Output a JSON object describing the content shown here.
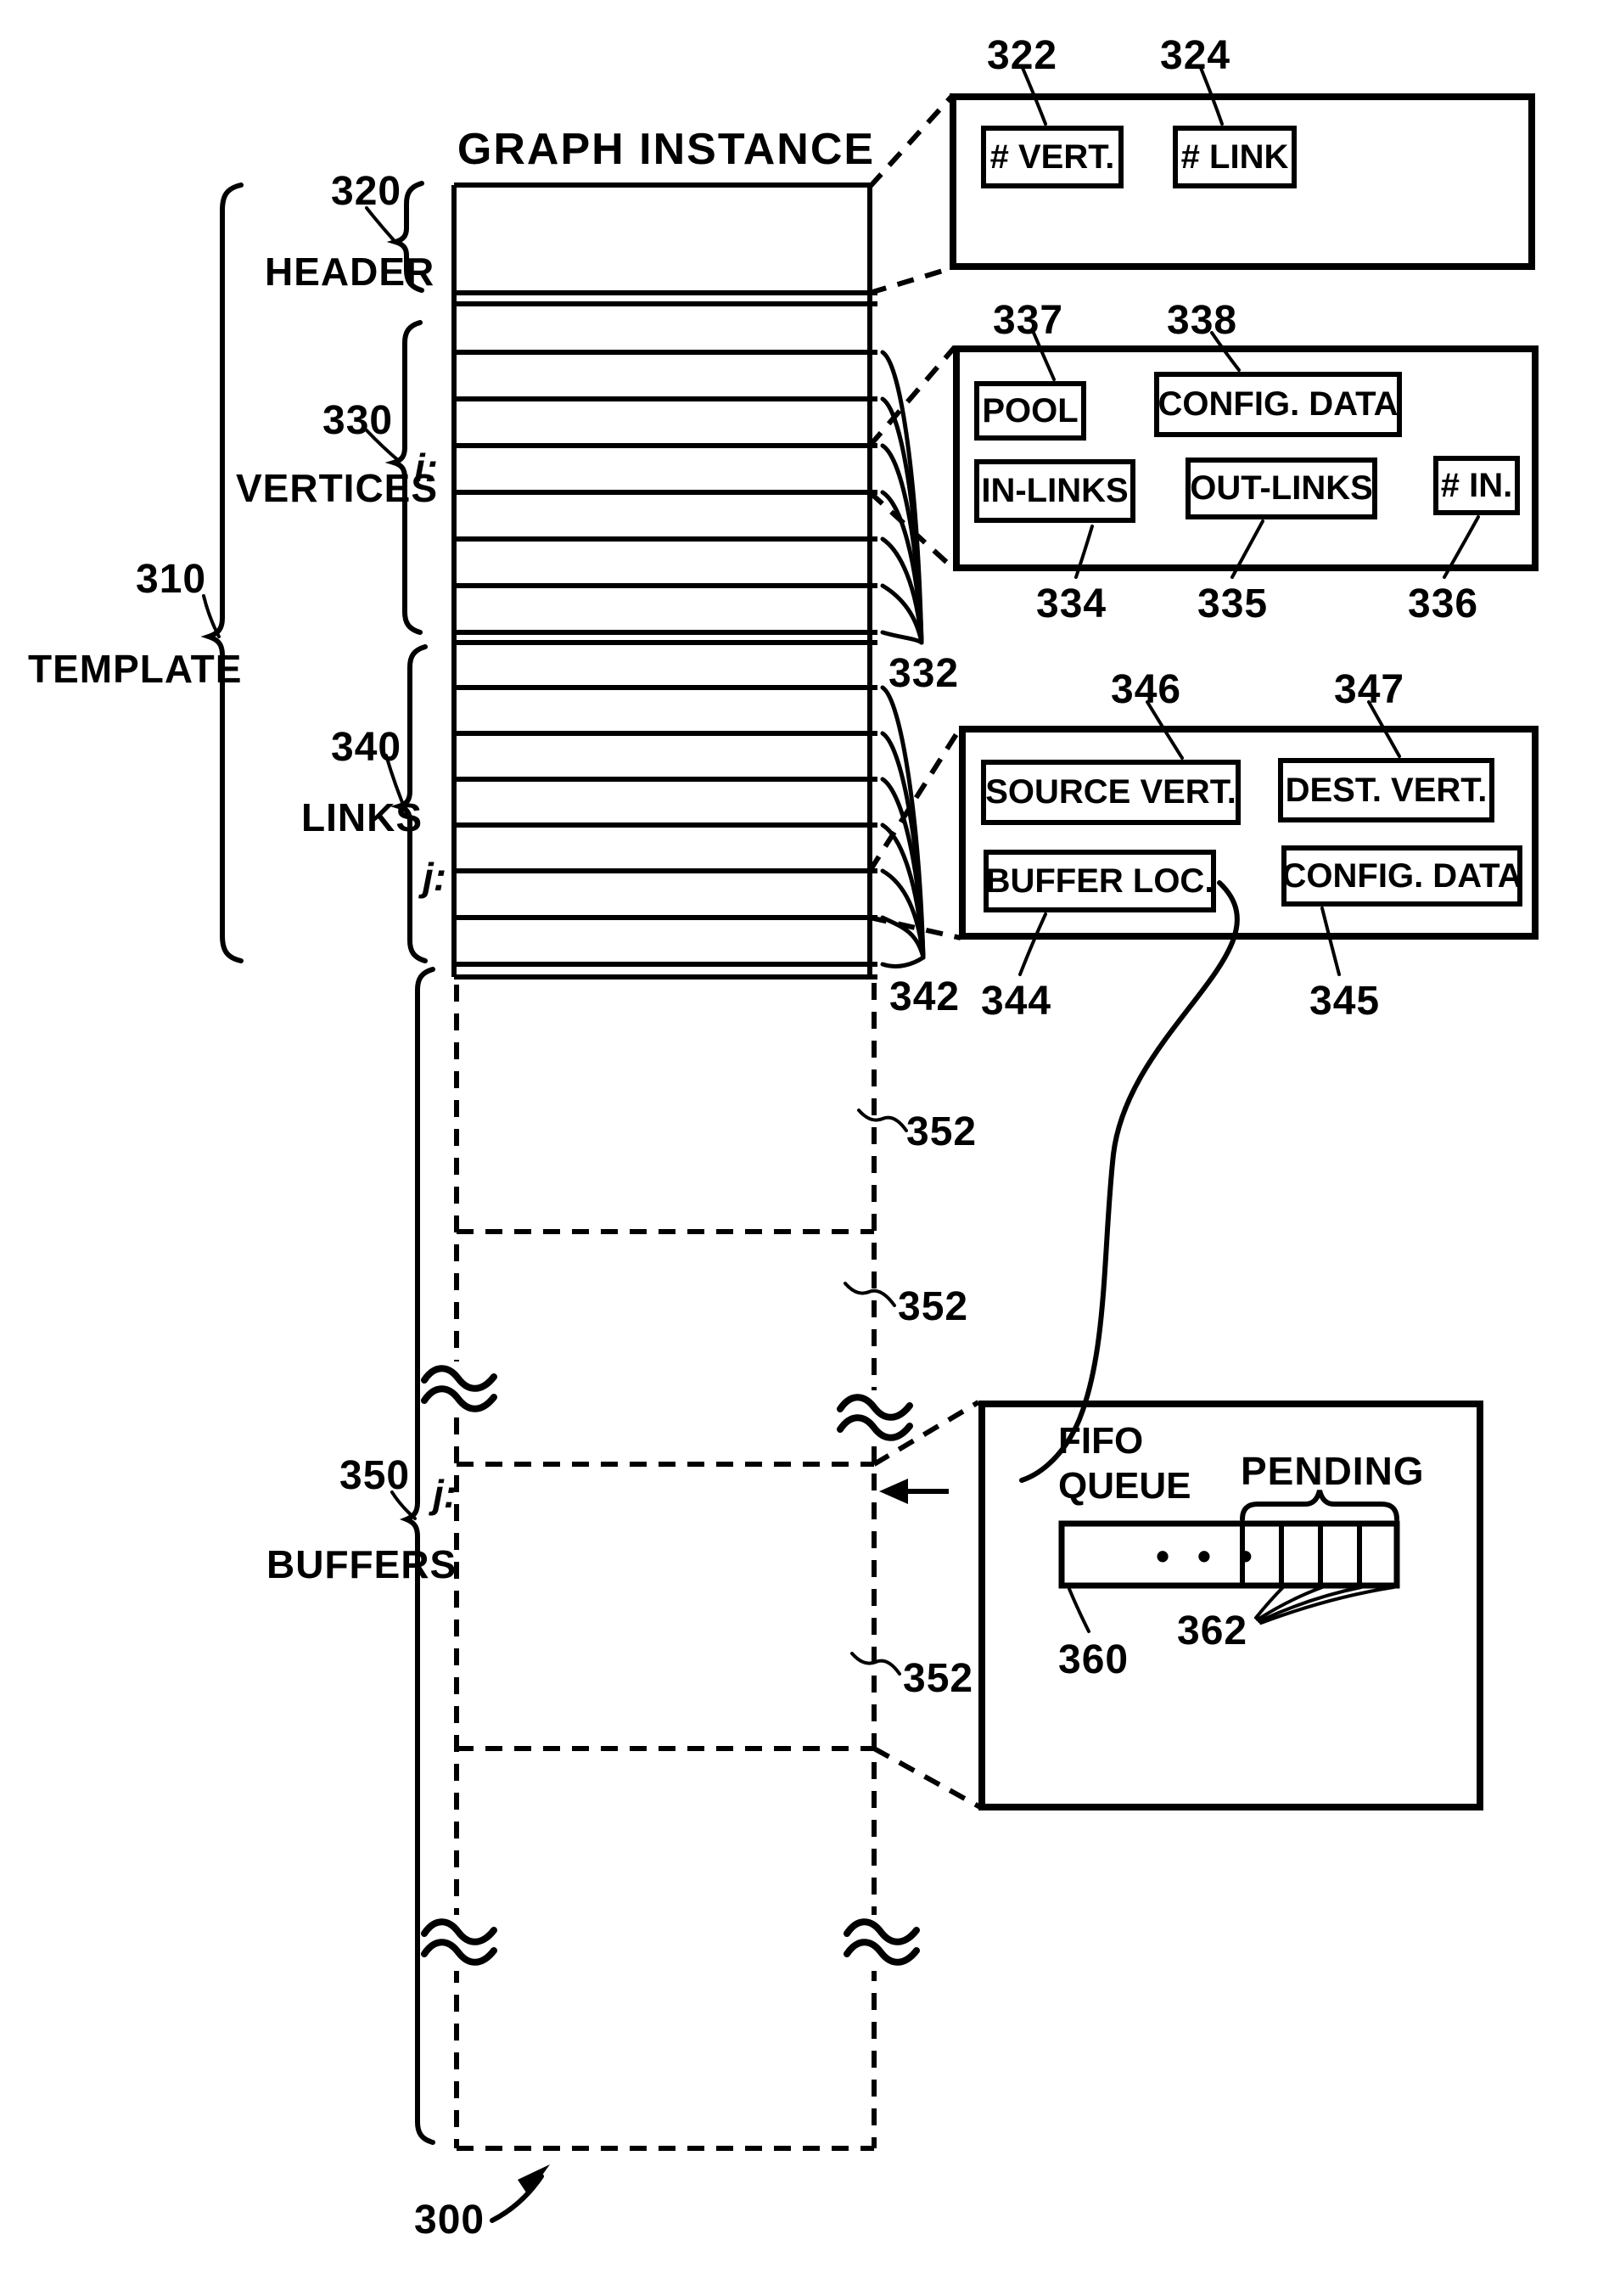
{
  "figure": {
    "title": "GRAPH INSTANCE",
    "figure_ref": "300",
    "template": {
      "ref": "310",
      "label": "TEMPLATE"
    },
    "sections": {
      "header": {
        "ref": "320",
        "label": "HEADER"
      },
      "vertices": {
        "ref": "330",
        "label": "VERTICES",
        "index_label": "i:"
      },
      "links": {
        "ref": "340",
        "label": "LINKS",
        "index_label": "j:"
      },
      "buffers": {
        "ref": "350",
        "label": "BUFFERS",
        "index_label": "j:",
        "segment_refs": [
          "352",
          "352",
          "352"
        ]
      }
    },
    "fan_refs": {
      "vertices": "332",
      "links": "342"
    },
    "detail_boxes": {
      "header": {
        "fields": [
          {
            "ref": "322",
            "label": "# VERT."
          },
          {
            "ref": "324",
            "label": "# LINK"
          }
        ]
      },
      "vertex": {
        "fields": [
          {
            "ref": "337",
            "label": "POOL"
          },
          {
            "ref": "338",
            "label": "CONFIG. DATA"
          },
          {
            "ref": "334",
            "label": "IN-LINKS"
          },
          {
            "ref": "335",
            "label": "OUT-LINKS"
          },
          {
            "ref": "336",
            "label": "# IN."
          }
        ]
      },
      "link": {
        "fields": [
          {
            "ref": "346",
            "label": "SOURCE VERT."
          },
          {
            "ref": "347",
            "label": "DEST. VERT."
          },
          {
            "ref": "344",
            "label": "BUFFER LOC."
          },
          {
            "ref": "345",
            "label": "CONFIG. DATA"
          }
        ]
      },
      "fifo": {
        "queue_label": "FIFO QUEUE",
        "pending_label": "PENDING",
        "dots": "• • •",
        "queue_ref": "360",
        "pending_ref": "362"
      }
    },
    "colors": {
      "ink": "#000000",
      "paper": "#ffffff"
    }
  }
}
